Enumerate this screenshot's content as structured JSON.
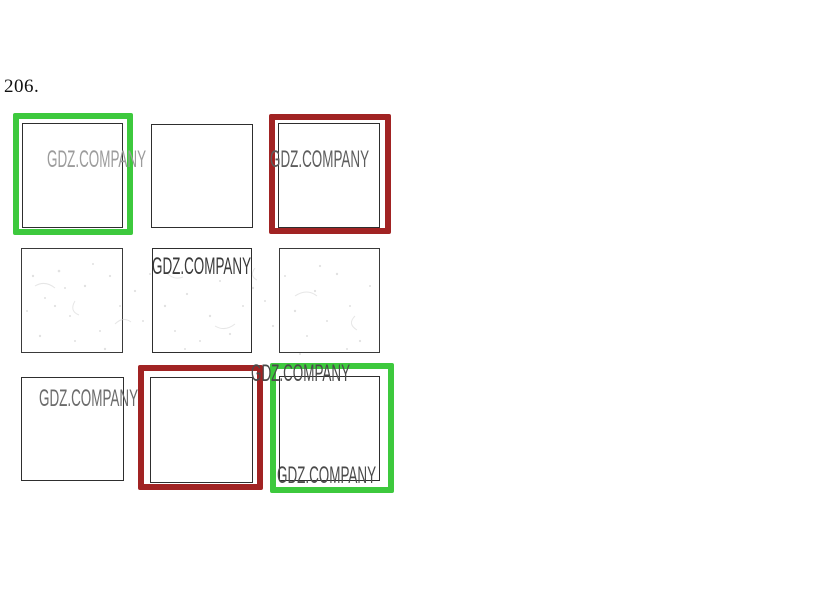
{
  "question": {
    "number": "206."
  },
  "watermark": {
    "text": "GDZ.COMPANY"
  },
  "grid": {
    "rows": 3,
    "cols": 3,
    "cells": [
      {
        "position": "row1-col1",
        "highlight": "green",
        "watermarks": [
          "center"
        ]
      },
      {
        "position": "row1-col2",
        "highlight": "none",
        "watermarks": []
      },
      {
        "position": "row1-col3",
        "highlight": "red",
        "watermarks": [
          "center"
        ]
      },
      {
        "position": "row2-col1",
        "highlight": "none",
        "watermarks": []
      },
      {
        "position": "row2-col2",
        "highlight": "none",
        "watermarks": [
          "top"
        ]
      },
      {
        "position": "row2-col3",
        "highlight": "none",
        "watermarks": []
      },
      {
        "position": "row3-col1",
        "highlight": "none",
        "watermarks": [
          "top"
        ]
      },
      {
        "position": "row3-col2",
        "highlight": "red",
        "watermarks": []
      },
      {
        "position": "row3-col3",
        "highlight": "green",
        "watermarks": [
          "above-top",
          "bottom"
        ]
      }
    ]
  },
  "colors": {
    "highlight_green": "#3dc93d",
    "highlight_red": "#a12323",
    "square_border": "#2e2e2e",
    "background": "#ffffff"
  }
}
